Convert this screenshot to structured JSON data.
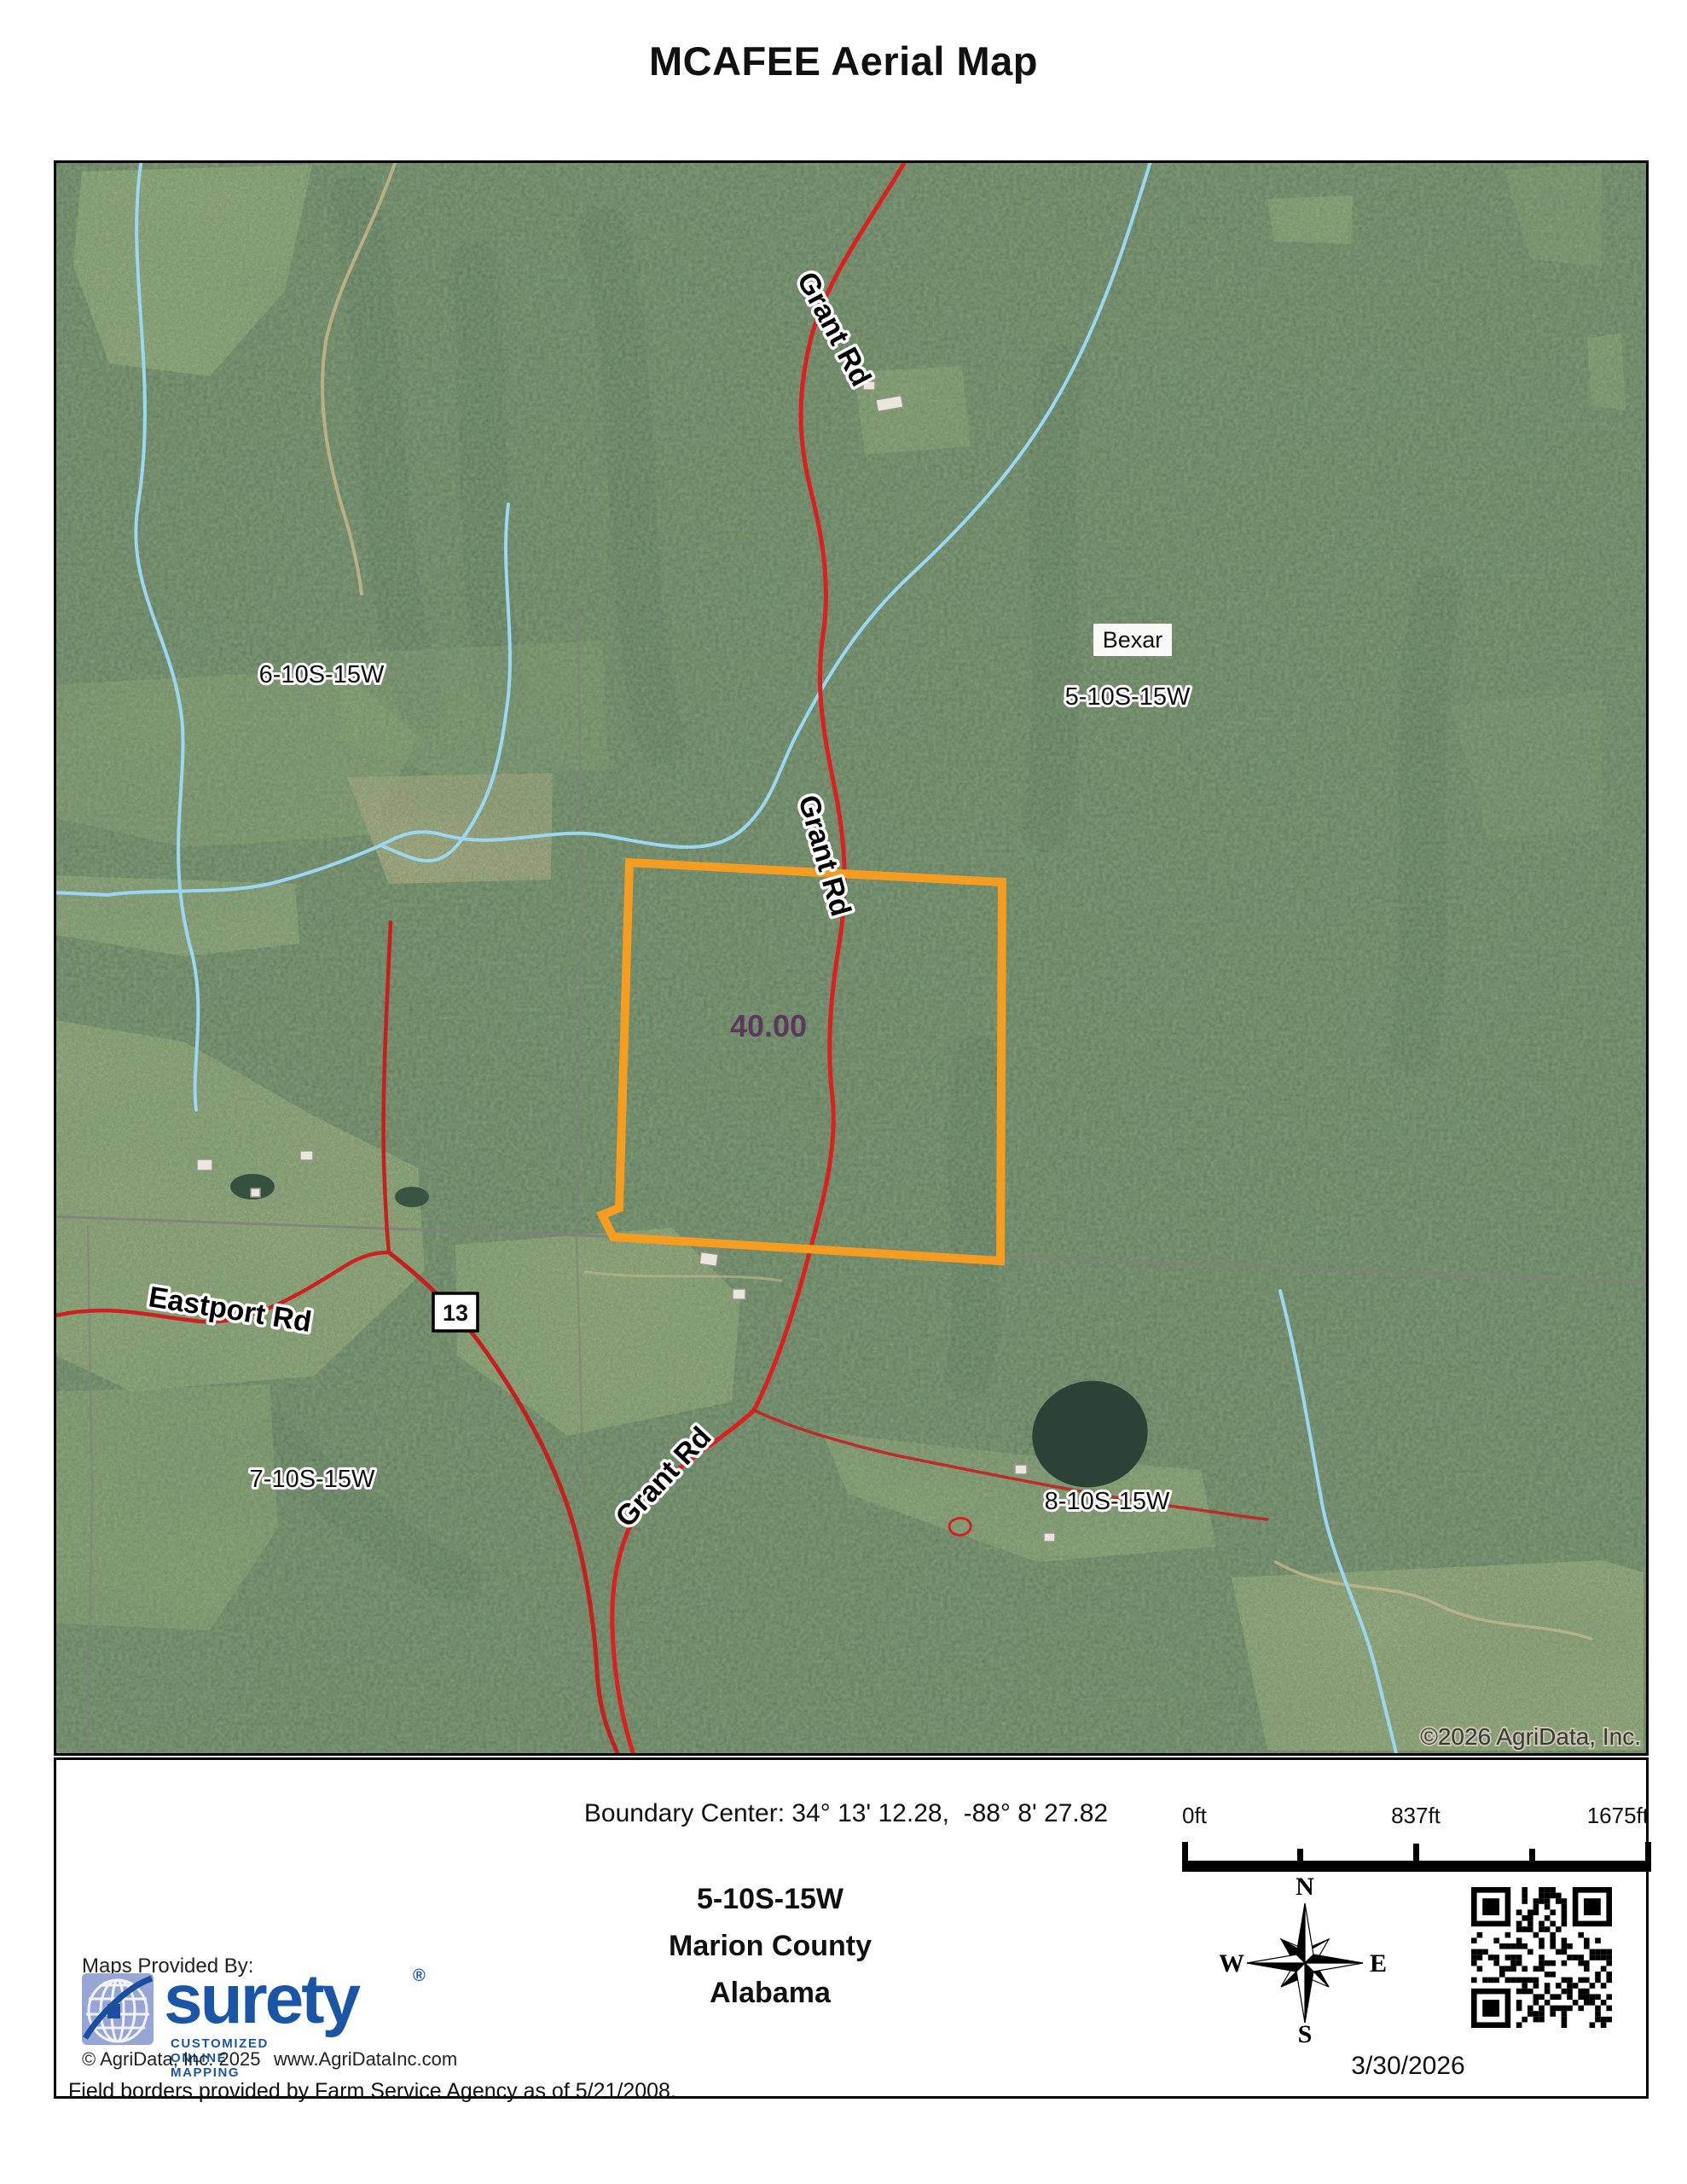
{
  "title": "MCAFEE Aerial Map",
  "map": {
    "road_labels": {
      "grant_rd": "Grant Rd",
      "eastport_rd": "Eastport Rd"
    },
    "highway_shield": "13",
    "place_label": "Bexar",
    "sections": {
      "nw": "6-10S-15W",
      "ne": "5-10S-15W",
      "sw": "7-10S-15W",
      "se": "8-10S-15W"
    },
    "parcel_acres": "40.00",
    "watermark": "©2026 AgriData, Inc."
  },
  "footer": {
    "boundary_center": "Boundary Center: 34° 13' 12.28,  -88° 8' 27.82",
    "scale": {
      "start": "0ft",
      "mid": "837ft",
      "end": "1675ft"
    },
    "location": {
      "section": "5-10S-15W",
      "county": "Marion County",
      "state": "Alabama"
    },
    "compass": {
      "n": "N",
      "e": "E",
      "s": "S",
      "w": "W"
    },
    "date": "3/30/2026",
    "provider": {
      "label": "Maps Provided By:",
      "brand": "surety",
      "registered": "®",
      "tagline": "CUSTOMIZED ONLINE MAPPING",
      "copyright": "© AgriData, Inc. 2025",
      "website": "www.AgriDataInc.com"
    },
    "field_note": "Field borders provided by Farm Service Agency as of 5/21/2008."
  },
  "colors": {
    "parcel_orange": "#F49D20",
    "road_red": "#D42020",
    "stream_blue": "#9BD7F2",
    "brand_blue": "#1A55A8",
    "acreage_purple": "#5A2D5C"
  }
}
